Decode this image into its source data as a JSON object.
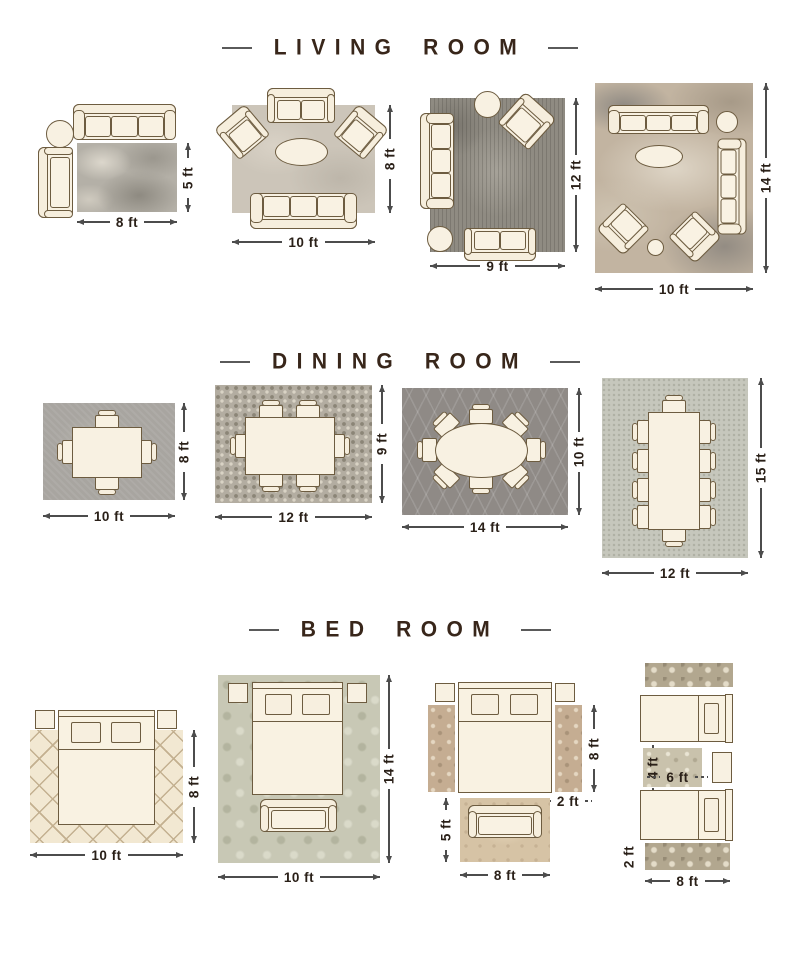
{
  "colors": {
    "background": "#ffffff",
    "furniture_fill": "#f8f1e2",
    "furniture_outline": "#6d5c40",
    "title_text": "#38261a",
    "dimension_text": "#2a2018",
    "dimension_line": "#4c4c4c"
  },
  "sections": [
    {
      "id": "living-room",
      "title": "LIVING ROOM",
      "layouts": [
        {
          "name": "living-room-rug-8x5",
          "width_label": "8 ft",
          "height_label": "5 ft"
        },
        {
          "name": "living-room-rug-10x8",
          "width_label": "10 ft",
          "height_label": "8 ft"
        },
        {
          "name": "living-room-rug-9x12",
          "width_label": "9 ft",
          "height_label": "12 ft"
        },
        {
          "name": "living-room-rug-10x14",
          "width_label": "10 ft",
          "height_label": "14 ft"
        }
      ]
    },
    {
      "id": "dining-room",
      "title": "DINING ROOM",
      "layouts": [
        {
          "name": "dining-room-rug-10x8",
          "width_label": "10 ft",
          "height_label": "8 ft"
        },
        {
          "name": "dining-room-rug-12x9",
          "width_label": "12 ft",
          "height_label": "9 ft"
        },
        {
          "name": "dining-room-rug-14x10",
          "width_label": "14 ft",
          "height_label": "10 ft"
        },
        {
          "name": "dining-room-rug-12x15",
          "width_label": "12 ft",
          "height_label": "15 ft"
        }
      ]
    },
    {
      "id": "bed-room",
      "title": "BED ROOM",
      "layouts": [
        {
          "name": "bed-room-rug-10x8",
          "width_label": "10 ft",
          "height_label": "8 ft"
        },
        {
          "name": "bed-room-rug-10x14",
          "width_label": "10 ft",
          "height_label": "14 ft"
        },
        {
          "name": "bed-room-runners-and-seating",
          "runner_length_label": "8 ft",
          "runner_width_label": "2 ft",
          "seating_rug_height_label": "5 ft",
          "seating_rug_width_label": "8 ft"
        },
        {
          "name": "bed-room-twin-beds",
          "accent_rug_height_label": "4 ft",
          "accent_rug_width_label": "6 ft",
          "runner_width_label": "2 ft",
          "runner_length_label": "8 ft"
        }
      ]
    }
  ]
}
